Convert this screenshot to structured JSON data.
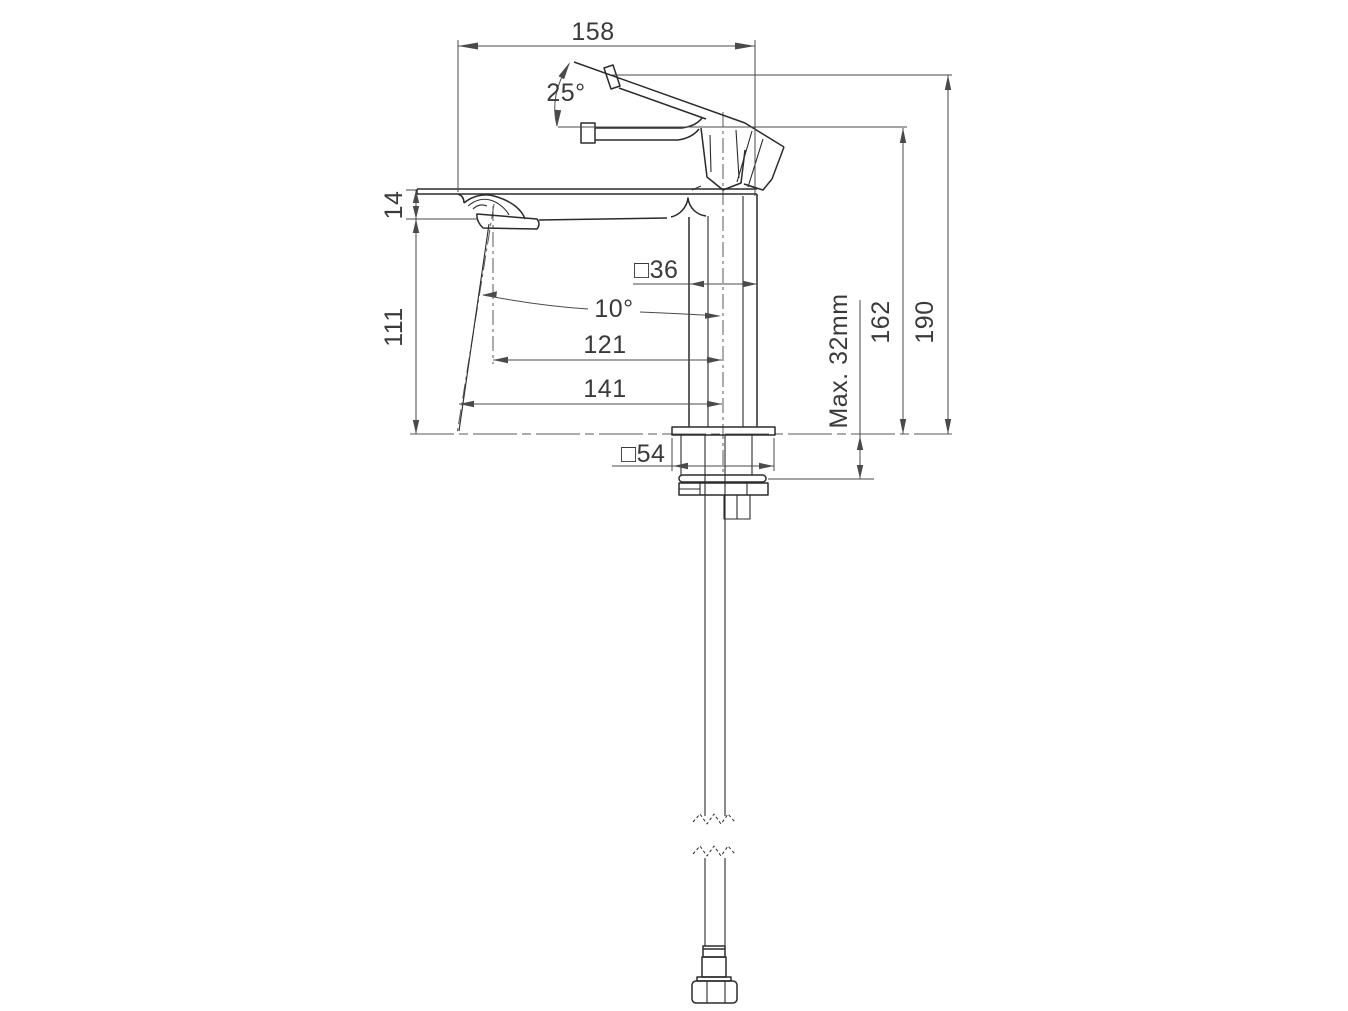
{
  "labels": {
    "overall_width": "158",
    "handle_open_angle": "25°",
    "spout_lip_height": "14",
    "underspout_height": "111",
    "body_square": "□36",
    "stream_angle": "10°",
    "reach_to_outlet": "121",
    "reach_to_stream": "141",
    "base_square": "□54",
    "max_deck_thickness": "Max. 32mm",
    "height_to_spout": "162",
    "overall_height": "190"
  },
  "colors": {
    "background": "#ffffff",
    "object_line": "#2b2b2b",
    "dimension_line": "#4a4a4a",
    "centerline": "#5a5a5a",
    "text": "#3a3a3a"
  }
}
